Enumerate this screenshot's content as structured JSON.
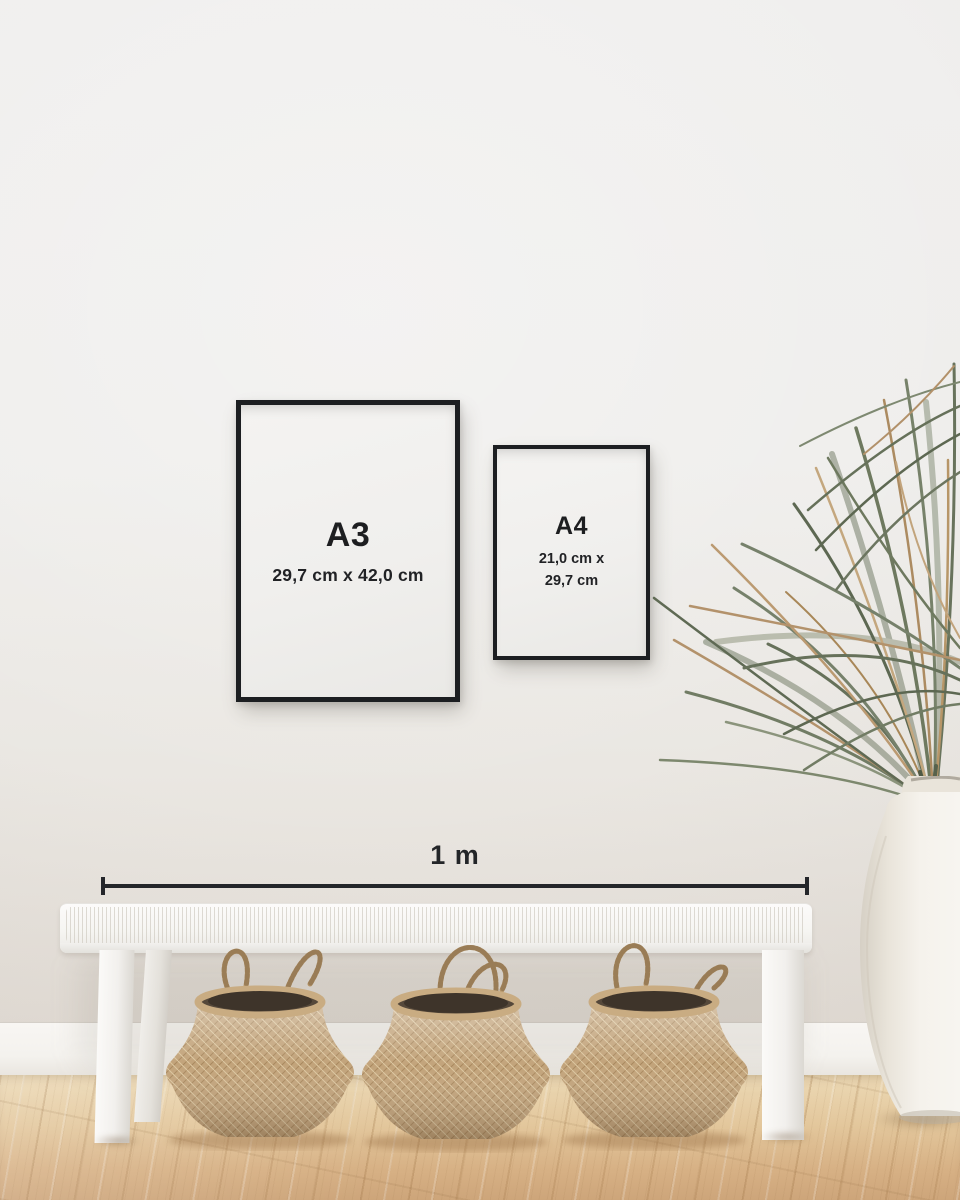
{
  "scene": {
    "frames": [
      {
        "id": "a3",
        "label": "A3",
        "dimensions": "29,7 cm x 42,0 cm"
      },
      {
        "id": "a4",
        "label": "A4",
        "dimensions_line1": "21,0 cm x",
        "dimensions_line2": "29,7 cm"
      }
    ],
    "scale_bar": {
      "label": "1 m"
    },
    "colors": {
      "wall": "#efeeec",
      "wall_lower": "#e3ddd6",
      "skirting": "#f6f4f1",
      "floor_light": "#ecd9b5",
      "floor_dark": "#cda57a",
      "frame_border": "#1c1e21",
      "frame_mat": "#f1f0ee",
      "text": "#1d1e20",
      "scale_line": "#24262a",
      "bench": "#f8f7f5",
      "basket": "#c2a37a",
      "basket_rope": "#b49467",
      "leaf_green": "#6c7660",
      "leaf_brown": "#b3926b",
      "vase": "#f5f2ec"
    }
  }
}
